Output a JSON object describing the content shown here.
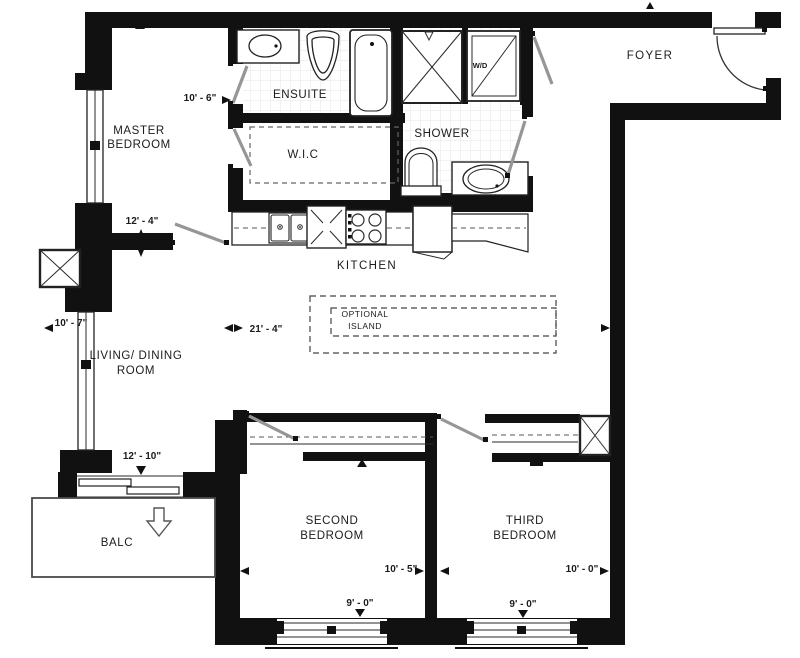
{
  "rooms": {
    "master1": "MASTER",
    "master2": "BEDROOM",
    "ensuite": "ENSUITE",
    "wic": "W.I.C",
    "shower": "SHOWER",
    "wd": "W/D",
    "foyer": "FOYER",
    "kitchen": "KITCHEN",
    "island1": "OPTIONAL",
    "island2": "ISLAND",
    "living1": "LIVING/ DINING",
    "living2": "ROOM",
    "balc": "BALC",
    "second1": "SECOND",
    "second2": "BEDROOM",
    "third1": "THIRD",
    "third2": "BEDROOM"
  },
  "dimensions": {
    "master_width": "10' - 6\"",
    "master_depth": "12' - 4\"",
    "living_width": "10' - 7\"",
    "living_length": "21' - 4\"",
    "balcony_width": "12' - 10\"",
    "second_width": "10' - 5\"",
    "second_depth": "9' - 0\"",
    "third_width": "10' - 0\"",
    "third_depth": "9' - 0\""
  },
  "colors": {
    "wall": "#111111",
    "line": "#222222",
    "door_leaf": "#969696",
    "tile_grid": "#e4e4e4",
    "paper": "#ffffff"
  }
}
